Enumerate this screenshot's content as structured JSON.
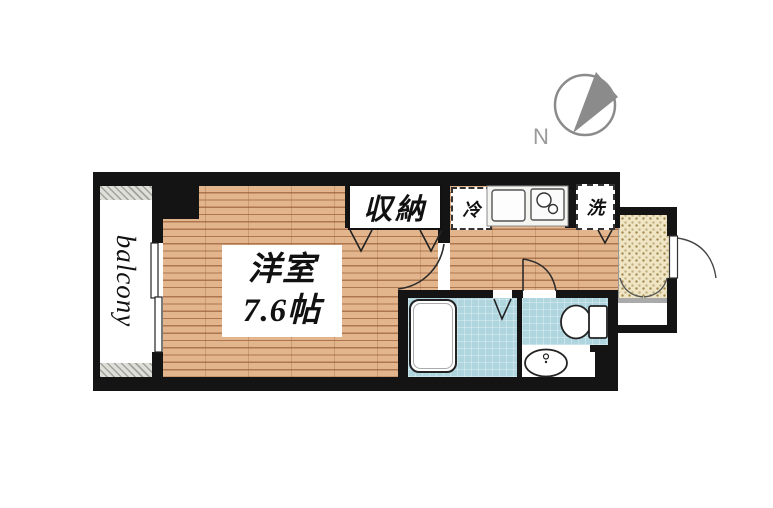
{
  "floorplan": {
    "balcony_label": "balcony",
    "room": {
      "name": "洋室",
      "size": "7.6帖"
    },
    "closet_label": "収納",
    "fridge_label": "冷",
    "washer_label": "洗",
    "compass": {
      "letter": "N"
    },
    "colors": {
      "wall": "#141414",
      "wood": "#e2b58d",
      "bath": "#afd6de",
      "genkan": "#efe5c4",
      "compass_gray": "#8b8b8b"
    }
  }
}
